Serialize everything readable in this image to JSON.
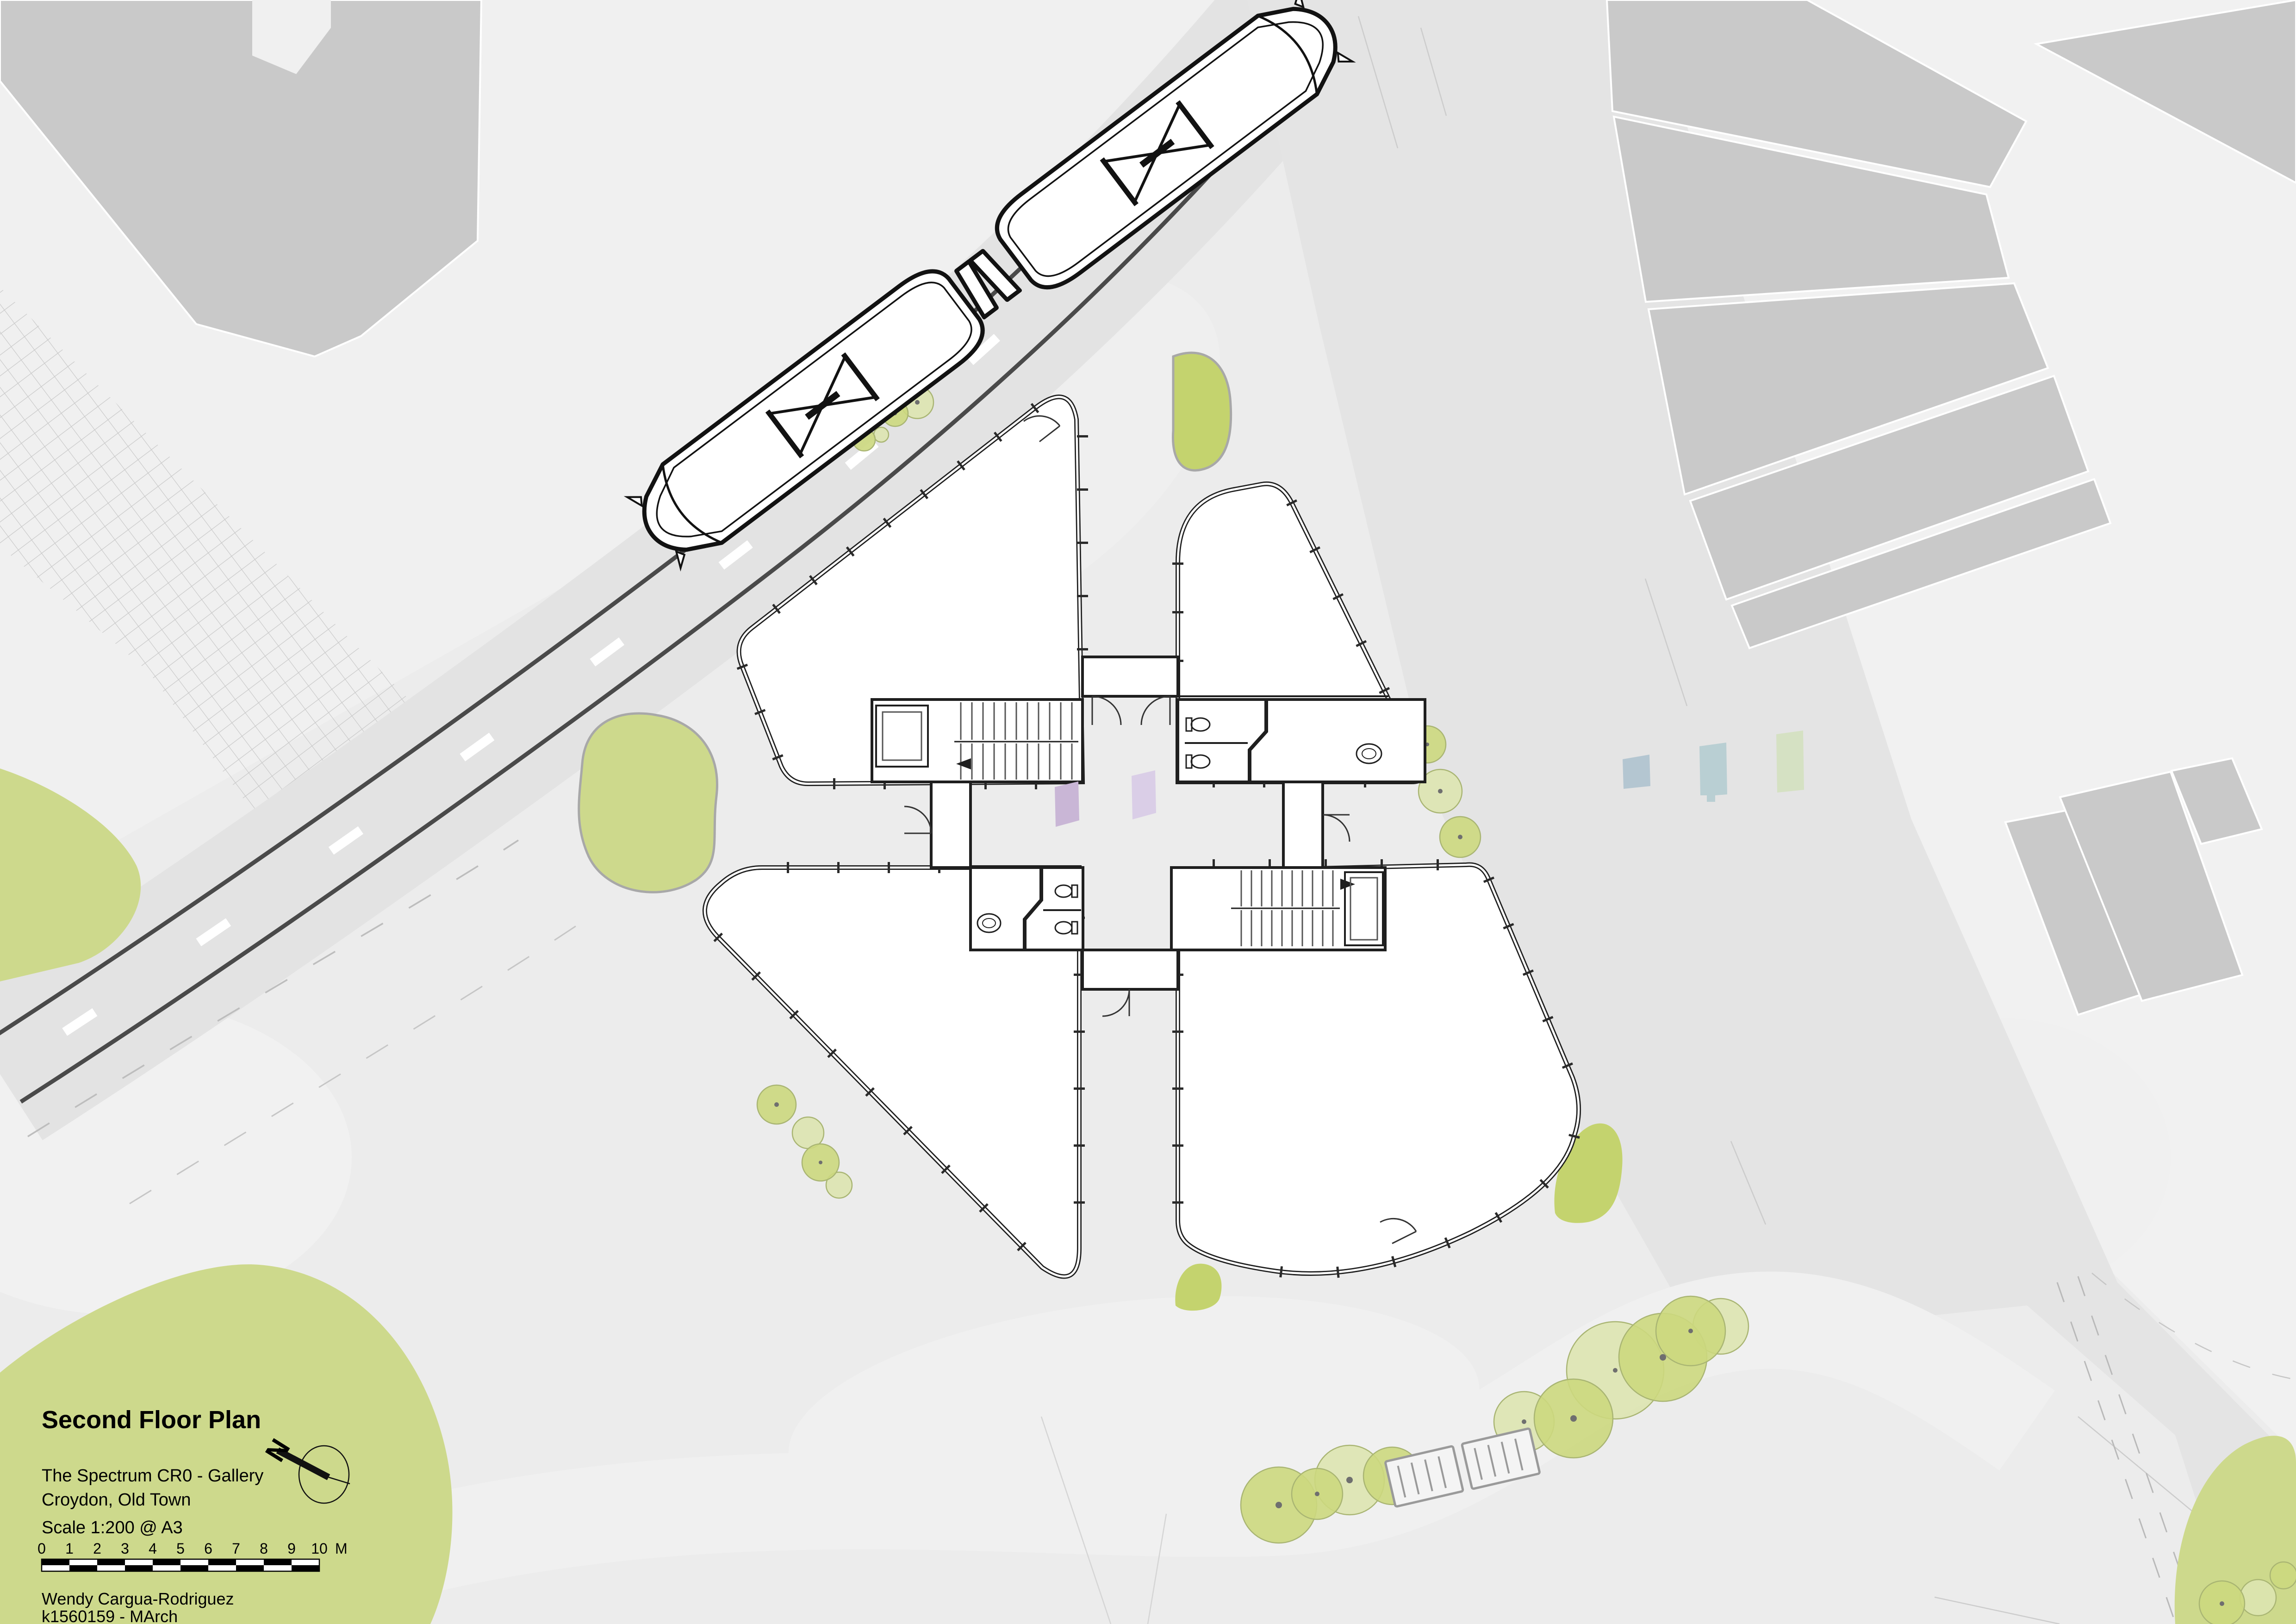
{
  "sheet_title": "Second Floor Plan",
  "project": {
    "name": "The Spectrum CR0 - Gallery",
    "location": "Croydon, Old Town"
  },
  "scale": {
    "note": "Scale 1:200 @ A3",
    "bar_labels": [
      "0",
      "1",
      "2",
      "3",
      "4",
      "5",
      "6",
      "7",
      "8",
      "9",
      "10"
    ],
    "unit": "M"
  },
  "author": {
    "name": "Wendy Cargua-Rodriguez",
    "id": "k1560159 - MArch"
  },
  "north_arrow": {
    "label": "N"
  },
  "palette": {
    "paper": "#ececec",
    "pavement_light": "#f1f1f1",
    "road": "#e3e3e3",
    "context_building": "#c9c9c9",
    "plan_outline": "#1f1f1f",
    "tram_track": "#4a4a4a",
    "grass": "#cdd98c",
    "tree_bright": "#ccd87e",
    "tree_pale": "#dde4b0",
    "tree_dot": "#6f6f6f",
    "art_wall_purple_1": "#c9b6d6",
    "art_wall_purple_2": "#dacee7",
    "panel_blue": "#b4c6d1",
    "panel_teal": "#b9cfd3",
    "panel_green": "#d5e1c3",
    "hatch_line": "#c9c9c9"
  }
}
